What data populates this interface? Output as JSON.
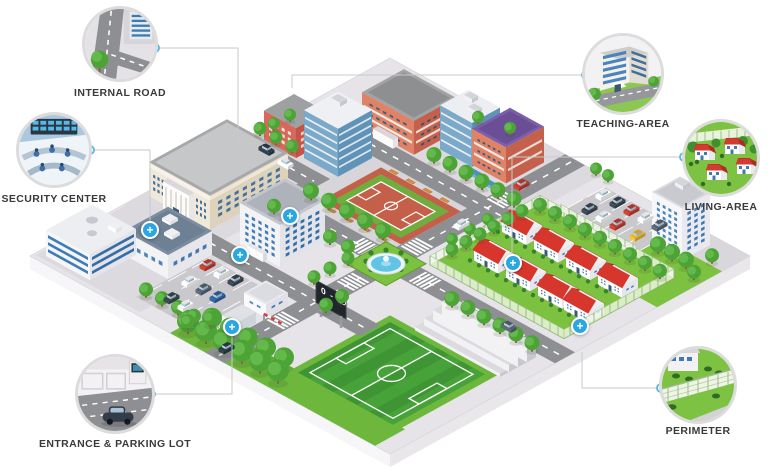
{
  "callouts": {
    "internal_road": {
      "label": "INTERNAL ROAD"
    },
    "security_center": {
      "label": "SECURITY CENTER"
    },
    "teaching_area": {
      "label": "TEACHING-AREA"
    },
    "living_area": {
      "label": "LIVING-AREA"
    },
    "entrance_parking": {
      "label": "ENTRANCE & PARKING LOT"
    },
    "perimeter": {
      "label": "PERIMETER"
    }
  },
  "map": {
    "scoreboard_text": "0 - 1",
    "marker_glyph": "+",
    "marker_count": 6
  },
  "colors": {
    "accent_blue": "#2aa7e1",
    "callout_line": "#c9c9c9",
    "callout_ring": "#dcdcdc",
    "label_text": "#3a3a3a"
  }
}
